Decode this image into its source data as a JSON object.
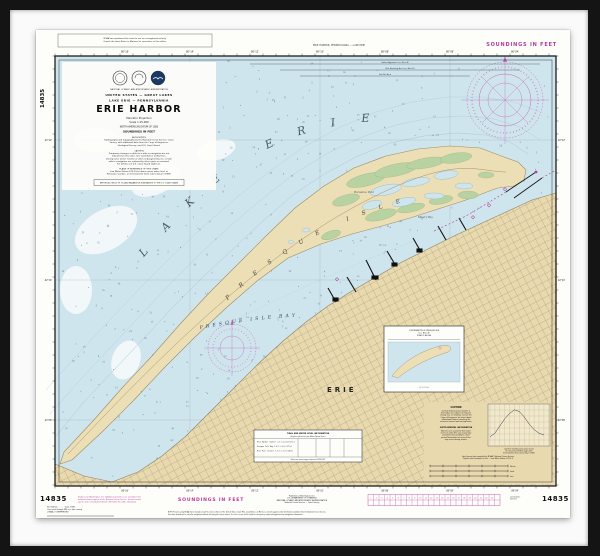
{
  "artwork": {
    "type_label": "framed nautical chart",
    "frame_color": "#141414",
    "mat_color": "#fafafa",
    "paper_color": "#fdfdfa"
  },
  "palette": {
    "water": "#cfe5ee",
    "deep_water": "#f4f9fb",
    "land_tan": "#e9d9ae",
    "peninsula_tan": "#ecdfb6",
    "marsh_green": "#b7d2a0",
    "magenta": "#b73a9c",
    "compass_magenta": "#c966b4",
    "sounding_gray": "#4f7183",
    "ink": "#1a1a1a"
  },
  "chart": {
    "number": "14835",
    "soundings_note_top": "SOUNDINGS IN FEET",
    "soundings_note_bottom": "SOUNDINGS IN FEET",
    "side_number_vertical": "14835",
    "number_bottom_left": "14835",
    "number_bottom_right": "14835",
    "top_margin_text": "ERIE HARBOR, PENNSYLVANIA — LAKE ERIE",
    "top_note_box_lines": [
      "NOAA has reproduced this chart for use as a navigational aid only.",
      "Consult the latest Notice to Mariners for corrections to this edition."
    ],
    "lon_labels": [
      "80°16'",
      "80°14'",
      "80°12'",
      "80°10'",
      "80°08'",
      "80°06'",
      "80°04'"
    ],
    "lat_labels": [
      "42°12'",
      "42°10'",
      "42°08'"
    ],
    "title_block": {
      "agency_small": "NATIONAL OCEANIC AND ATMOSPHERIC ADMINISTRATION",
      "line1": "UNITED STATES — GREAT LAKES",
      "line2": "LAKE ERIE — PENNSYLVANIA",
      "title": "ERIE HARBOR",
      "projection": "Mercator Projection",
      "scale": "Scale 1:15,000",
      "datum": "NORTH AMERICAN DATUM OF 1983",
      "soundings_small": "SOUNDINGS IN FEET",
      "authorities_lines": [
        "AUTHORITIES",
        "Hydrography and topography by the National Ocean Service, Coast",
        "Survey, with additional data from the Corps of Engineers,",
        "Geological Survey, and U.S. Coast Guard."
      ],
      "caution_lines": [
        "CAUTION",
        "Temporary changes or defects in aids to navigation are not",
        "indicated on this chart. See Local Notice to Mariners.",
        "During some winter months or when endangered by ice, certain",
        "aids to navigation are replaced by other types or removed.",
        "For details see U.S. Coast Guard Light List."
      ],
      "plane_lines": [
        "PLANE OF REFERENCE OF THIS CHART",
        "Low Water Datum 570.5 feet above mean water level at",
        "Rimouski, Quebec, on International Great Lakes Datum (1985)"
      ],
      "pollution_box": "REPORT ALL SPILLS OF OIL AND HAZARDOUS SUBSTANCES TO THE U.S. COAST GUARD"
    },
    "map_labels": {
      "lake": "LAKE ERIE",
      "peninsula": "PRESQUE ISLE",
      "bay": "PRESQUE ISLE BAY",
      "city": "ERIE",
      "misery_bay": "Misery Bay",
      "horseshoe_pond": "Horseshoe Pond"
    },
    "approach_lines": [
      "Harbor Approach (see Note A)",
      "Pilot Boarding Area (see Note B)",
      "Fish Net Area"
    ],
    "inset": {
      "header_lines": [
        "CONTINUATION OF PRESQUE ISLE",
        "(see Note A)",
        "SCALE 1:80,000"
      ],
      "scale_row": "0        1        2        3        4"
    },
    "table_box": {
      "title": "TIDAL AND WATER LEVEL INFORMATION",
      "subtitle": "Heights referred to Low Water Datum (feet)",
      "rows": [
        "Erie Harbor (Outer)    2.1   1.4   0.8   571.2",
        "Presque Isle Bay       1.8   1.2   0.6   571.0",
        "Erie Pier (Inner)      1.6   1.1   0.5   570.8"
      ],
      "footnote": "Values are mean ranges observed 1918–2007"
    },
    "notes_area": {
      "caution_title": "CAUTION",
      "caution_lines": [
        "Limited federal project depths in",
        "this harbor are subject to frequent",
        "change due to shoaling. Consult the",
        "Corps of Engineers for latest depth",
        "information before transiting the",
        "entrance channel and turning basin."
      ],
      "supp_title": "SUPPLEMENTAL INFORMATION",
      "supp_lines": [
        "Mariners are cautioned that water",
        "levels on Lake Erie vary seasonally",
        "and with wind conditions; short",
        "period fluctuations of several feet",
        "may occur during storms."
      ],
      "bottom_lines": [
        "Lake Survey data compiled by NOAA / National Ocean Service",
        "Depths and elevations in feet — Low Water Datum 570.5 ft"
      ],
      "graph_caption_lines": [
        "Lake Erie monthly mean water levels",
        "for the period 1918 through 2007",
        "(International Great Lakes Datum 1985)"
      ],
      "graph_values": [
        4,
        6,
        10,
        14,
        17,
        19,
        18,
        15,
        11,
        8,
        6,
        5
      ],
      "scale_bar_labels": [
        "Meters",
        "Yards",
        "Feet"
      ]
    },
    "bottom_margin": {
      "magenta_note_lines": [
        "Produced at Washington, D.C.  Additional quantities are available from",
        "authorized sales agents of the National Ocean Service.  For prices and",
        "agents write:  Distribution Branch (N/CG33), Riverdale, Maryland."
      ],
      "black_note_lines": [
        "First Edition . . . . . . Sept. 1936",
        "Corrected through NM: see date stamp",
        "LORAN-C OVERPRINTED"
      ],
      "publisher_lines": [
        "Published at Washington, D.C.",
        "U.S. DEPARTMENT OF COMMERCE",
        "NATIONAL OCEANIC AND ATMOSPHERIC ADMINISTRATION",
        "National Ocean Service — Coast Survey"
      ],
      "long_note_lines": [
        "NOTE: Persons using NOAA charts should consult the latest editions of the United States Coast Pilot, Local Notices to Mariners, and all supplemental information available from the National Ocean Service;",
        "this chart should not be used for navigation without checking all current notices. See the reverse of this chart for emergency repair and supplemental navigation information."
      ],
      "list_lines": [
        "List Number",
        "30th Ed."
      ]
    }
  },
  "map": {
    "polygons": {
      "mainland": [
        [
          19,
          434
        ],
        [
          48,
          446
        ],
        [
          76,
          452
        ],
        [
          102,
          442
        ],
        [
          126,
          426
        ],
        [
          150,
          406
        ],
        [
          174,
          382
        ],
        [
          198,
          358
        ],
        [
          222,
          334
        ],
        [
          246,
          312
        ],
        [
          270,
          292
        ],
        [
          292,
          276
        ],
        [
          316,
          261
        ],
        [
          340,
          247
        ],
        [
          366,
          232
        ],
        [
          392,
          219
        ],
        [
          418,
          206
        ],
        [
          444,
          194
        ],
        [
          470,
          182
        ],
        [
          496,
          170
        ],
        [
          520,
          163
        ],
        [
          520,
          456
        ],
        [
          19,
          456
        ]
      ],
      "peninsula": [
        [
          28,
          422
        ],
        [
          57,
          391
        ],
        [
          86,
          358
        ],
        [
          116,
          326
        ],
        [
          145,
          293
        ],
        [
          174,
          262
        ],
        [
          203,
          233
        ],
        [
          232,
          204
        ],
        [
          259,
          178
        ],
        [
          288,
          156
        ],
        [
          318,
          138
        ],
        [
          350,
          126
        ],
        [
          382,
          119
        ],
        [
          414,
          116
        ],
        [
          444,
          118
        ],
        [
          468,
          127
        ],
        [
          482,
          132
        ],
        [
          490,
          140
        ],
        [
          488,
          150
        ],
        [
          478,
          156
        ],
        [
          462,
          158
        ],
        [
          456,
          160
        ],
        [
          430,
          170
        ],
        [
          402,
          179
        ],
        [
          374,
          188
        ],
        [
          346,
          196
        ],
        [
          316,
          204
        ],
        [
          285,
          214
        ],
        [
          252,
          228
        ],
        [
          221,
          251
        ],
        [
          190,
          278
        ],
        [
          159,
          307
        ],
        [
          128,
          338
        ],
        [
          98,
          370
        ],
        [
          67,
          401
        ],
        [
          36,
          430
        ],
        [
          24,
          434
        ]
      ]
    },
    "soundings": {
      "seed": 7,
      "count": 300,
      "min": 1,
      "max": 36,
      "color": "#4f7183"
    },
    "reject_boxes": [
      [
        24,
        30,
        158,
        132
      ],
      [
        346,
        294,
        84,
        70
      ],
      [
        216,
        398,
        112,
        34
      ],
      [
        386,
        370,
        132,
        84
      ],
      [
        22,
        4,
        154,
        17
      ],
      [
        432,
        33,
        76,
        76
      ]
    ]
  }
}
